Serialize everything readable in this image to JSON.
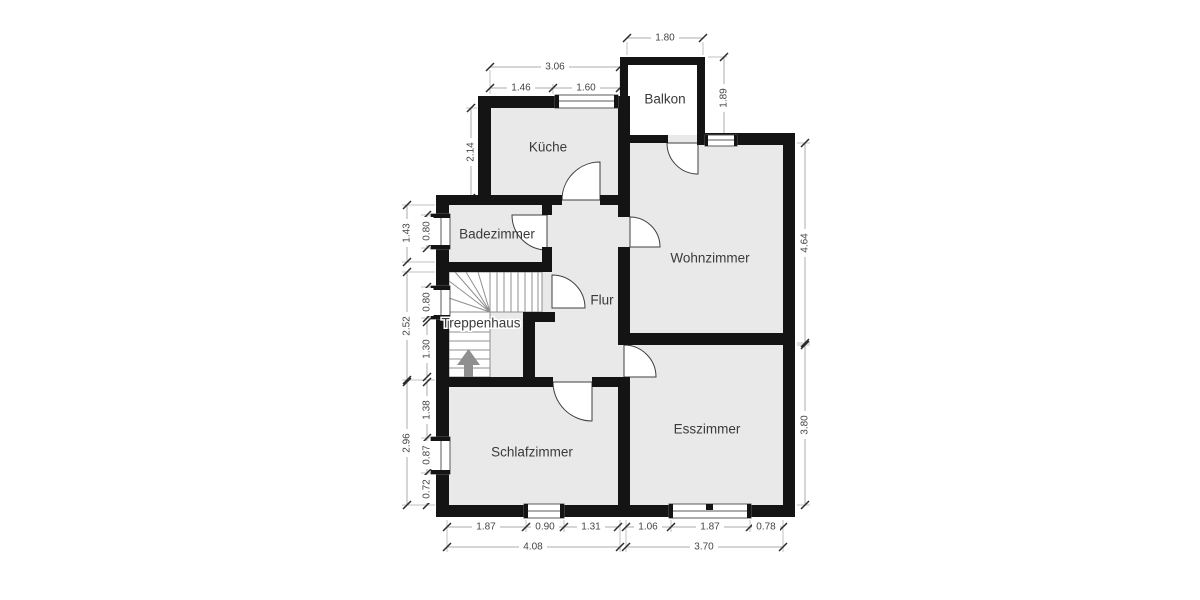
{
  "colors": {
    "wall": "#141414",
    "room_fill": "#e9e9e9",
    "balkon_fill": "#ffffff",
    "dim_line": "#ababab",
    "dim_text": "#454545",
    "room_text": "#3a3a3a",
    "stair_line": "#8f8f8f",
    "arrow": "#8f8f8f"
  },
  "rooms": [
    {
      "id": "balkon",
      "label": "Balkon",
      "x": 665,
      "y": 99
    },
    {
      "id": "kueche",
      "label": "Küche",
      "x": 548,
      "y": 147
    },
    {
      "id": "badezimmer",
      "label": "Badezimmer",
      "x": 497,
      "y": 234
    },
    {
      "id": "wohnzimmer",
      "label": "Wohnzimmer",
      "x": 710,
      "y": 258
    },
    {
      "id": "flur",
      "label": "Flur",
      "x": 602,
      "y": 300
    },
    {
      "id": "treppenhaus",
      "label": "Treppenhaus",
      "x": 481,
      "y": 323
    },
    {
      "id": "schlafzimmer",
      "label": "Schlafzimmer",
      "x": 532,
      "y": 452
    },
    {
      "id": "esszimmer",
      "label": "Esszimmer",
      "x": 707,
      "y": 429
    }
  ],
  "dims": [
    {
      "id": "balkon-width",
      "value": "1.80",
      "x": 665,
      "y": 38,
      "rot": 0
    },
    {
      "id": "kueche-width-total",
      "value": "3.06",
      "x": 555,
      "y": 67,
      "rot": 0
    },
    {
      "id": "kueche-width-left",
      "value": "1.46",
      "x": 521,
      "y": 88,
      "rot": 0
    },
    {
      "id": "kueche-width-right",
      "value": "1.60",
      "x": 586,
      "y": 88,
      "rot": 0
    },
    {
      "id": "kueche-height",
      "value": "2.14",
      "x": 471,
      "y": 152,
      "rot": -90
    },
    {
      "id": "badezimmer-height",
      "value": "1.43",
      "x": 407,
      "y": 233,
      "rot": -90
    },
    {
      "id": "badezimmer-window",
      "value": "0.80",
      "x": 427,
      "y": 231,
      "rot": -90
    },
    {
      "id": "treppenhaus-height",
      "value": "2.52",
      "x": 407,
      "y": 326,
      "rot": -90
    },
    {
      "id": "treppenhaus-window",
      "value": "0.80",
      "x": 427,
      "y": 302,
      "rot": -90
    },
    {
      "id": "treppenhaus-lower",
      "value": "1.30",
      "x": 427,
      "y": 349,
      "rot": -90
    },
    {
      "id": "schlafzimmer-height",
      "value": "2.96",
      "x": 407,
      "y": 443,
      "rot": -90
    },
    {
      "id": "schlafzimmer-upper",
      "value": "1.38",
      "x": 427,
      "y": 410,
      "rot": -90
    },
    {
      "id": "schlafzimmer-window-left",
      "value": "0.87",
      "x": 427,
      "y": 455,
      "rot": -90
    },
    {
      "id": "schlafzimmer-lower",
      "value": "0.72",
      "x": 427,
      "y": 489,
      "rot": -90
    },
    {
      "id": "balkon-height",
      "value": "1.89",
      "x": 724,
      "y": 98,
      "rot": -90
    },
    {
      "id": "wohnzimmer-height",
      "value": "4.64",
      "x": 805,
      "y": 243,
      "rot": -90
    },
    {
      "id": "esszimmer-height",
      "value": "3.80",
      "x": 805,
      "y": 425,
      "rot": -90
    },
    {
      "id": "schlafzimmer-bottom-left",
      "value": "1.87",
      "x": 486,
      "y": 527,
      "rot": 0
    },
    {
      "id": "schlafzimmer-bottom-window",
      "value": "0.90",
      "x": 545,
      "y": 527,
      "rot": 0
    },
    {
      "id": "schlafzimmer-bottom-right",
      "value": "1.31",
      "x": 591,
      "y": 527,
      "rot": 0
    },
    {
      "id": "esszimmer-bottom-left",
      "value": "1.06",
      "x": 648,
      "y": 527,
      "rot": 0
    },
    {
      "id": "esszimmer-bottom-window",
      "value": "1.87",
      "x": 710,
      "y": 527,
      "rot": 0
    },
    {
      "id": "esszimmer-bottom-right",
      "value": "0.78",
      "x": 766,
      "y": 527,
      "rot": 0
    },
    {
      "id": "schlafzimmer-width-total",
      "value": "4.08",
      "x": 533,
      "y": 547,
      "rot": 0
    },
    {
      "id": "esszimmer-width-total",
      "value": "3.70",
      "x": 704,
      "y": 547,
      "rot": 0
    }
  ]
}
